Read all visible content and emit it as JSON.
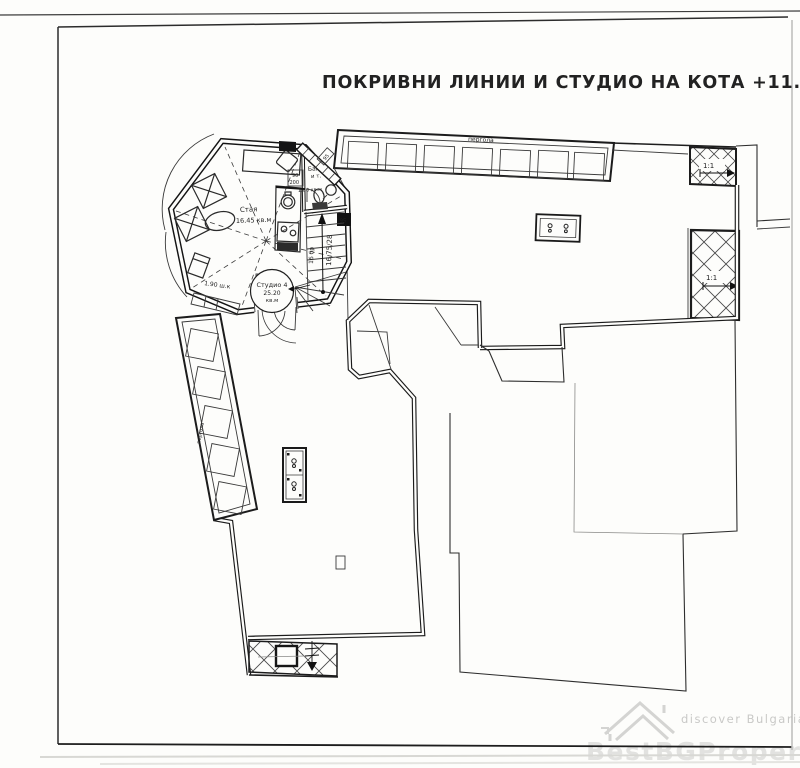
{
  "title": "ПОКРИВНИ ЛИНИИ И СТУДИО НА КОТА +11.22",
  "plan": {
    "pergola_top_label": "пергола",
    "pergola_left_label": "пергола",
    "slope_top_right": "1:1",
    "slope_right": "1:1",
    "room": {
      "name": "Стая",
      "area": "16.45 кв.м"
    },
    "bathroom": {
      "name": "Баня",
      "name2": "и т.",
      "area": "1.80 кв.м"
    },
    "door_bathroom": {
      "width": "90",
      "height": "200"
    },
    "door_studio": {
      "width": "80",
      "height": "250"
    },
    "door_small": "95",
    "panel_label": "95",
    "wardrobe_label": "1.90 ш.к",
    "stairs": {
      "steps": "16 бр",
      "dimensions": "16.75/28"
    },
    "studio_badge": {
      "line1": "Студио 4",
      "line2": "25.20",
      "line3": "кв.м"
    }
  },
  "watermark": {
    "tagline": "discover Bulgaria",
    "brand": "BestBGProperties"
  },
  "colors": {
    "ink": "#1f1f1f",
    "watermark_gray": "#d9d9d9",
    "paper": "#fdfdfb"
  }
}
